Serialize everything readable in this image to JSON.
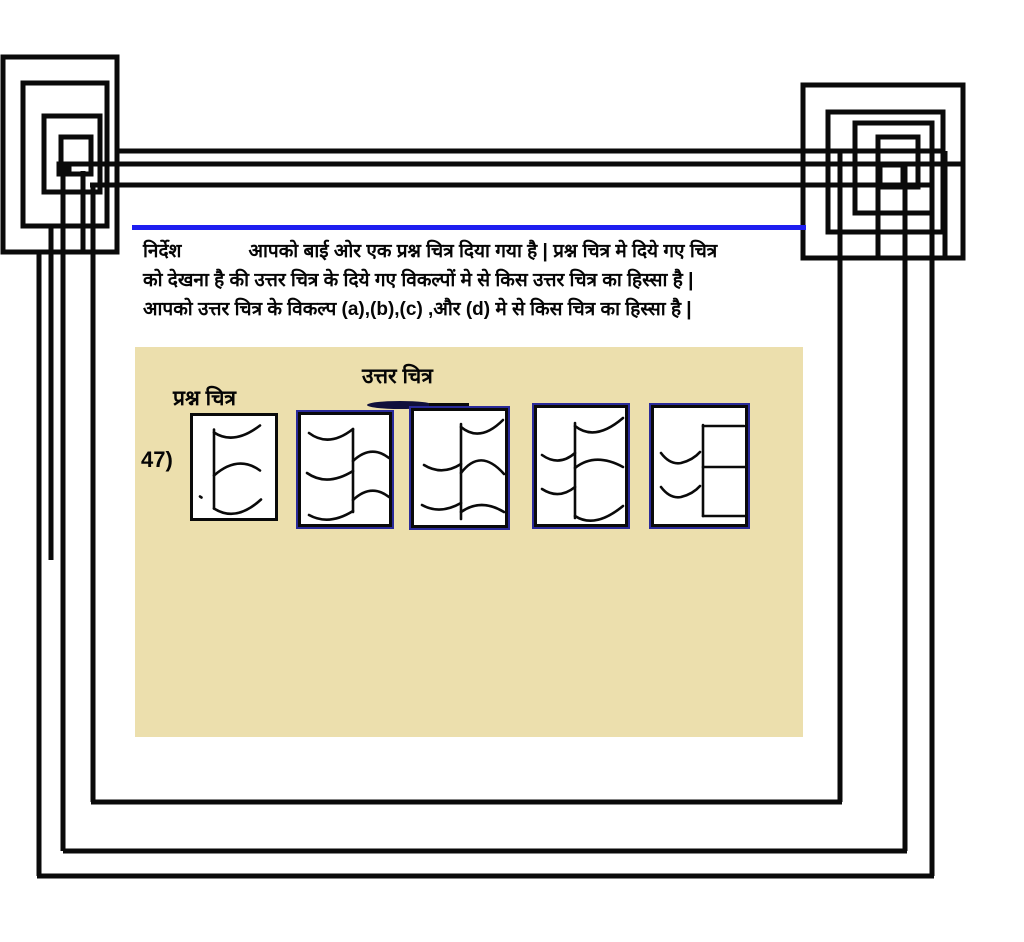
{
  "colors": {
    "ink": "#0a0a0a",
    "accent_blue": "#1e1ef0",
    "panel_bg": "#ecdfad",
    "option_border_navy": "#2a2a9a"
  },
  "instructions": {
    "label": "निर्देश",
    "line1": "आपको बाई ओर एक प्रश्न चित्र दिया गया है | प्रश्न चित्र मे दिये गए चित्र",
    "line2": "को देखना है की उत्तर चित्र के दिये गए विकल्पों मे से किस उत्तर चित्र का हिस्सा है |",
    "line3": "आपको उत्तर चित्र के विकल्प (a),(b),(c) ,और (d) मे से किस चित्र का हिस्सा है  |"
  },
  "question": {
    "number": "47)",
    "question_figure_label": "प्रश्न चित्र",
    "answer_figure_label": "उत्तर चित्र",
    "options": [
      "a",
      "b",
      "c",
      "d"
    ]
  },
  "figures": {
    "q": [
      "M21 13 L21 92",
      "M21 16 Q41 29 67 9",
      "M21 59 Q45 38 67 54",
      "M21 92 Q43 106 68 83",
      "M7 80 l1.5 1"
    ],
    "a": [
      "M52 14 L52 97",
      "M8 18 Q28 33 52 14",
      "M6 58 Q26 72 52 56",
      "M8 100 Q28 111 52 96",
      "M52 46 Q70 29 88 43",
      "M52 85 Q70 68 88 82"
    ],
    "b": [
      "M47 13 L47 108",
      "M47 16 Q66 32 89 9",
      "M10 54 Q28 65 47 53",
      "M47 62 C60 45 74 45 90 63",
      "M8 94 Q26 104 47 92",
      "M47 101 Q67 87 90 101"
    ],
    "c": [
      "M38 15 L38 110",
      "M38 18 Q58 34 86 10",
      "M5 47 Q22 59 38 45",
      "M38 60 Q58 44 86 59",
      "M5 81 Q22 92 38 79",
      "M38 108 Q58 121 86 98"
    ],
    "d": [
      "M49 17 L49 108",
      "M49 18 L90 18",
      "M49 59 L92 59",
      "M49 108 L93 108",
      "M7 45 Q16 57 27 55 Q39 52 46 44",
      "M7 79 Q16 91 27 89 Q39 86 46 78"
    ]
  }
}
